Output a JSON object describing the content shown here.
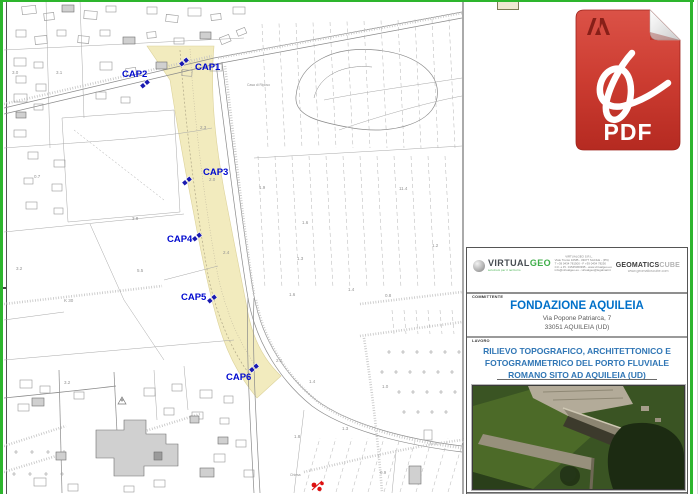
{
  "page": {
    "frame_color": "#2db52d",
    "map_highlight_color": "#f2ebbe",
    "cap_label_color": "#0009cf",
    "cap_marker_color": "#1a1ab0",
    "red_symbol_color": "#dd1111"
  },
  "map": {
    "caps": [
      {
        "text": "CAP1",
        "lx": 191,
        "ly": 70,
        "mx": 180,
        "my": 62
      },
      {
        "text": "CAP2",
        "lx": 118,
        "ly": 77,
        "mx": 141,
        "my": 84
      },
      {
        "text": "CAP3",
        "lx": 199,
        "ly": 175,
        "mx": 183,
        "my": 181
      },
      {
        "text": "CAP4",
        "lx": 163,
        "ly": 242,
        "mx": 193,
        "my": 237
      },
      {
        "text": "CAP5",
        "lx": 177,
        "ly": 300,
        "mx": 208,
        "my": 299
      },
      {
        "text": "CAP6",
        "lx": 222,
        "ly": 380,
        "mx": 250,
        "my": 368
      }
    ],
    "spot_elevations": [
      {
        "t": "3.0",
        "x": 8,
        "y": 74
      },
      {
        "t": "3.1",
        "x": 52,
        "y": 74
      },
      {
        "t": "2.3",
        "x": 196,
        "y": 129
      },
      {
        "t": "0.7",
        "x": 30,
        "y": 178
      },
      {
        "t": "2.0",
        "x": 205,
        "y": 181
      },
      {
        "t": "1.9",
        "x": 255,
        "y": 189
      },
      {
        "t": "3.8",
        "x": 128,
        "y": 220
      },
      {
        "t": "1.6",
        "x": 298,
        "y": 224
      },
      {
        "t": "1.2",
        "x": 428,
        "y": 247
      },
      {
        "t": "2.4",
        "x": 219,
        "y": 254
      },
      {
        "t": "1.3",
        "x": 293,
        "y": 260
      },
      {
        "t": "3.2",
        "x": 12,
        "y": 270
      },
      {
        "t": "5.5",
        "x": 133,
        "y": 272
      },
      {
        "t": "11.4",
        "x": 395,
        "y": 190
      },
      {
        "t": "1.4",
        "x": 344,
        "y": 291
      },
      {
        "t": "0.8",
        "x": 381,
        "y": 297
      },
      {
        "t": "1.6",
        "x": 285,
        "y": 296
      },
      {
        "t": "K 30",
        "x": 60,
        "y": 302
      },
      {
        "t": "2.1",
        "x": 272,
        "y": 362
      },
      {
        "t": "3.2",
        "x": 60,
        "y": 384
      },
      {
        "t": "1.4",
        "x": 305,
        "y": 383
      },
      {
        "t": "1.0",
        "x": 378,
        "y": 388
      },
      {
        "t": "1.3",
        "x": 338,
        "y": 430
      },
      {
        "t": "1.8",
        "x": 290,
        "y": 438
      },
      {
        "t": "0.9",
        "x": 376,
        "y": 474
      }
    ],
    "place_labels": [
      {
        "t": "Casa di Riposo",
        "x": 243,
        "y": 86
      },
      {
        "t": "Chiesa",
        "x": 286,
        "y": 476
      }
    ]
  },
  "pdf_icon": {
    "label": "PDF"
  },
  "title_block": {
    "virtualgeo": {
      "name_prefix": "VIRTUAL",
      "name_suffix": "GEO",
      "suffix_color": "#3fae49",
      "tagline": "soluzioni per il territorio"
    },
    "company_info_lines": [
      "VIRTUALGEO S.R.L.",
      "Viale Trento 105/B - 33077 SACILE - (PN)",
      "T +39 0434 781500 - F +39 0434 78250",
      "C.F. e P.I. 01545360935 - www.virtualgeo.eu",
      "info@virtualgeo.eu - virtualgeo@legalmail.it"
    ],
    "geomatics": {
      "name_prefix": "GEOMATICS",
      "name_suffix": "CUBE",
      "suffix_color": "#b3b3b3",
      "url": "www.geomaticscube.com"
    },
    "committente_label": "COMMITTENTE",
    "client": {
      "name": "FONDAZIONE AQUILEIA",
      "name_color": "#0070c9",
      "address1": "Via Popone Patriarca, 7",
      "address2": "33051 AQUILEIA (UD)"
    },
    "lavoro_label": "LAVORO",
    "work_title_color": "#3076b5",
    "work_title_lines": [
      "RILIEVO TOPOGRAFICO, ARCHITETTONICO E",
      "FOTOGRAMMETRICO DEL PORTO FLUVIALE",
      "ROMANO SITO AD AQUILEIA (UD)"
    ]
  }
}
